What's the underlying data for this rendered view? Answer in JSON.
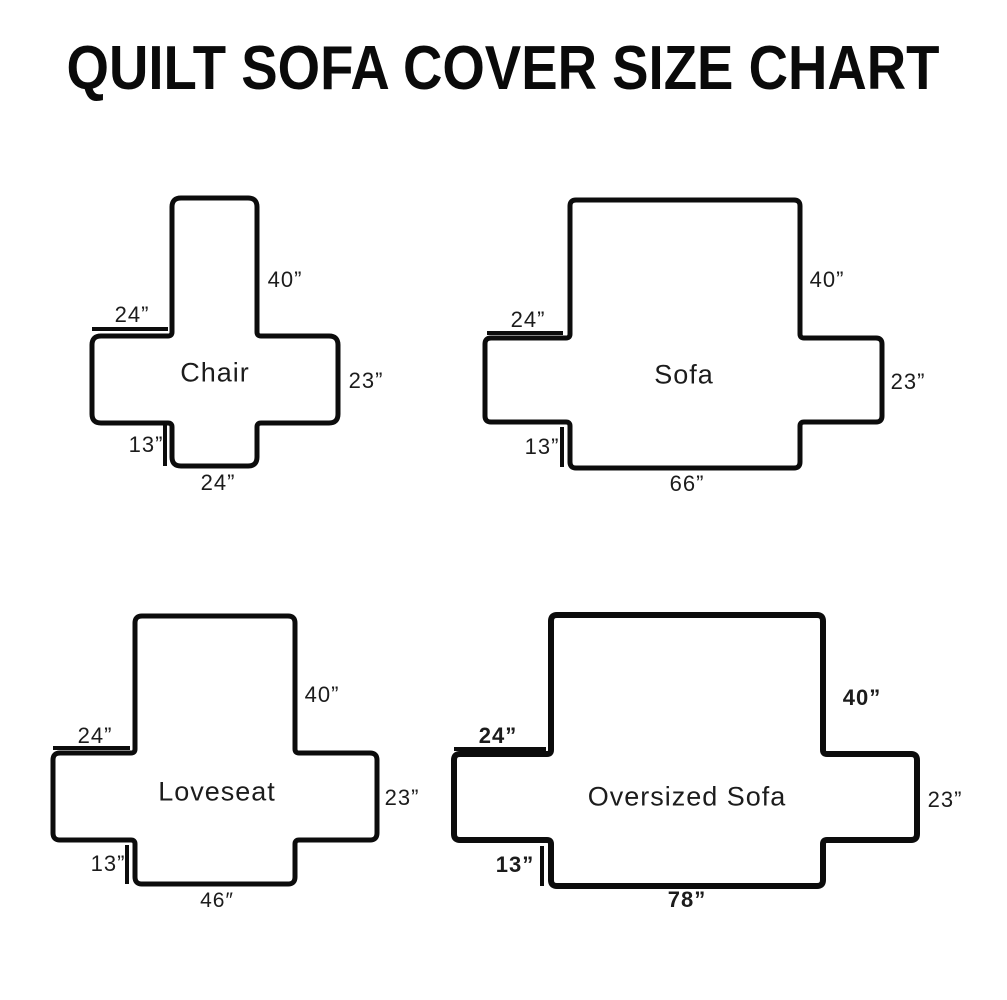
{
  "title": "QUILT SOFA COVER SIZE CHART",
  "colors": {
    "ink": "#0c0c0c",
    "background": "#ffffff"
  },
  "diagrams": [
    {
      "id": "chair",
      "name": "Chair",
      "name_pos": {
        "x": 215,
        "y": 373
      },
      "shape": {
        "vl": 172,
        "vr": 257,
        "top": 198,
        "bottom": 466,
        "band_top": 336,
        "band_bottom": 423,
        "band_left": 92,
        "band_right": 338,
        "corner_radius": 9,
        "inner_radius": 4,
        "stroke_width": 5
      },
      "measure_lines": [
        {
          "role": "arm-width-tick",
          "type": "h",
          "y": 329,
          "x1": 92,
          "x2": 168
        },
        {
          "role": "skirt-height-tick",
          "type": "v",
          "x": 165,
          "y1": 424,
          "y2": 466
        }
      ],
      "labels": [
        {
          "role": "back-height",
          "text": "40”",
          "x": 285,
          "y": 280,
          "bold": false
        },
        {
          "role": "arm-width",
          "text": "24”",
          "x": 132,
          "y": 315,
          "bold": false
        },
        {
          "role": "seat-side-height",
          "text": "23”",
          "x": 366,
          "y": 381,
          "bold": false
        },
        {
          "role": "skirt-height",
          "text": "13”",
          "x": 146,
          "y": 445,
          "bold": false
        },
        {
          "role": "seat-width",
          "text": "24”",
          "x": 218,
          "y": 483,
          "bold": false
        }
      ]
    },
    {
      "id": "sofa",
      "name": "Sofa",
      "name_pos": {
        "x": 684,
        "y": 375
      },
      "shape": {
        "vl": 570,
        "vr": 800,
        "top": 200,
        "bottom": 468,
        "band_top": 338,
        "band_bottom": 422,
        "band_left": 485,
        "band_right": 882,
        "corner_radius": 6,
        "inner_radius": 4,
        "stroke_width": 5
      },
      "measure_lines": [
        {
          "role": "arm-width-tick",
          "type": "h",
          "y": 333,
          "x1": 487,
          "x2": 563
        },
        {
          "role": "skirt-height-tick",
          "type": "v",
          "x": 562,
          "y1": 427,
          "y2": 467
        }
      ],
      "labels": [
        {
          "role": "back-height",
          "text": "40”",
          "x": 827,
          "y": 280,
          "bold": false
        },
        {
          "role": "arm-width",
          "text": "24”",
          "x": 528,
          "y": 320,
          "bold": false
        },
        {
          "role": "seat-side-height",
          "text": "23”",
          "x": 908,
          "y": 382,
          "bold": false
        },
        {
          "role": "skirt-height",
          "text": "13”",
          "x": 542,
          "y": 447,
          "bold": false
        },
        {
          "role": "seat-width",
          "text": "66”",
          "x": 687,
          "y": 484,
          "bold": false
        }
      ]
    },
    {
      "id": "loveseat",
      "name": "Loveseat",
      "name_pos": {
        "x": 217,
        "y": 792
      },
      "shape": {
        "vl": 135,
        "vr": 295,
        "top": 616,
        "bottom": 884,
        "band_top": 753,
        "band_bottom": 840,
        "band_left": 53,
        "band_right": 377,
        "corner_radius": 7,
        "inner_radius": 4,
        "stroke_width": 5
      },
      "measure_lines": [
        {
          "role": "arm-width-tick",
          "type": "h",
          "y": 748,
          "x1": 53,
          "x2": 130
        },
        {
          "role": "skirt-height-tick",
          "type": "v",
          "x": 127,
          "y1": 845,
          "y2": 884
        }
      ],
      "labels": [
        {
          "role": "back-height",
          "text": "40”",
          "x": 322,
          "y": 695,
          "bold": false
        },
        {
          "role": "arm-width",
          "text": "24”",
          "x": 95,
          "y": 736,
          "bold": false
        },
        {
          "role": "seat-side-height",
          "text": "23”",
          "x": 402,
          "y": 798,
          "bold": false
        },
        {
          "role": "skirt-height",
          "text": "13”",
          "x": 108,
          "y": 864,
          "bold": false
        },
        {
          "role": "seat-width",
          "text": "46″",
          "x": 217,
          "y": 901,
          "bold": false,
          "small_prime": true
        }
      ]
    },
    {
      "id": "oversized-sofa",
      "name": "Oversized Sofa",
      "name_pos": {
        "x": 687,
        "y": 797
      },
      "shape": {
        "vl": 551,
        "vr": 823,
        "top": 615,
        "bottom": 886,
        "band_top": 754,
        "band_bottom": 840,
        "band_left": 454,
        "band_right": 917,
        "corner_radius": 6,
        "inner_radius": 4,
        "stroke_width": 6
      },
      "measure_lines": [
        {
          "role": "arm-width-tick",
          "type": "h",
          "y": 749,
          "x1": 454,
          "x2": 546
        },
        {
          "role": "skirt-height-tick",
          "type": "v",
          "x": 542,
          "y1": 846,
          "y2": 886
        }
      ],
      "labels": [
        {
          "role": "back-height",
          "text": "40”",
          "x": 862,
          "y": 698,
          "bold": true
        },
        {
          "role": "arm-width",
          "text": "24”",
          "x": 498,
          "y": 736,
          "bold": true
        },
        {
          "role": "seat-side-height",
          "text": "23”",
          "x": 945,
          "y": 800,
          "bold": false
        },
        {
          "role": "skirt-height",
          "text": "13”",
          "x": 515,
          "y": 865,
          "bold": true
        },
        {
          "role": "seat-width",
          "text": "78”",
          "x": 687,
          "y": 900,
          "bold": true
        }
      ]
    }
  ]
}
